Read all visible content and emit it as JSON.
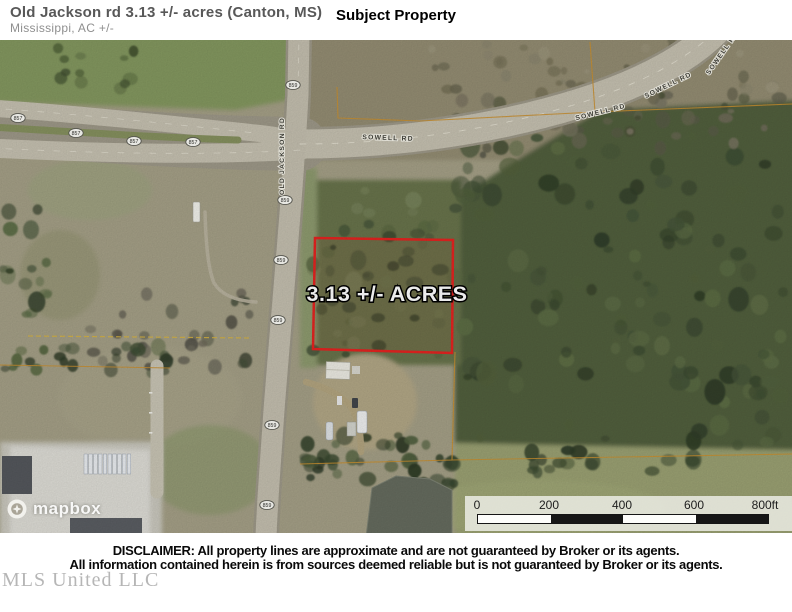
{
  "header": {
    "title": "Old Jackson rd 3.13 +/- acres (Canton, MS)",
    "subtitle": "Mississippi,  AC +/-",
    "center_label": "Subject Property"
  },
  "map": {
    "parcel_label": "3.13 +/- ACRES",
    "road_labels": {
      "sowell": "SOWELL RD",
      "old_jackson": "OLD JACKSON RD"
    },
    "shields": {
      "horizontal": "857",
      "vertical": "859"
    },
    "attribution": "mapbox",
    "scale_bar": {
      "ticks": [
        "0",
        "200",
        "400",
        "600",
        "800ft"
      ]
    },
    "colors": {
      "parcel_outline": "#e42320",
      "boundary_tan": "#c98f2f"
    }
  },
  "footer": {
    "disclaimer_line1": "DISCLAIMER: All property lines are approximate and are not guaranteed by Broker or its agents.",
    "disclaimer_line2": "All information contained herein is from sources deemed reliable but is not guaranteed by Broker or its agents.",
    "watermark": "MLS United LLC"
  }
}
